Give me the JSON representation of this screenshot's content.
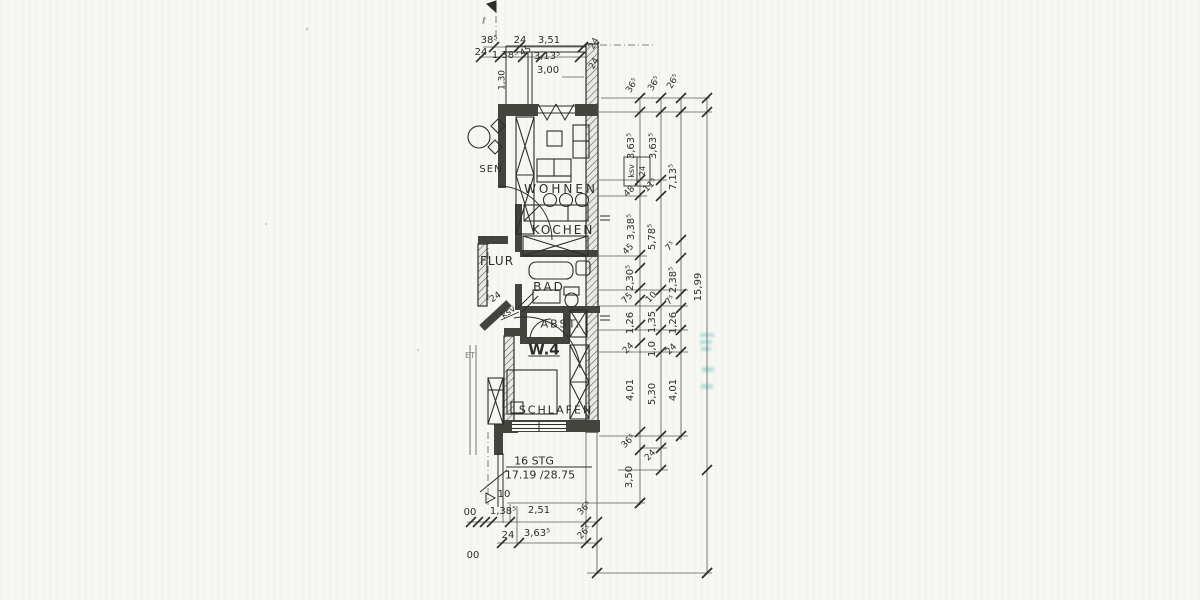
{
  "colors": {
    "paper": "#f7f7f4",
    "ink": "#2c2c2a",
    "wall": "#44443f",
    "stamp_teal": "#86cfc5"
  },
  "plan": {
    "apartment": "W.4",
    "room_names": [
      "WOHNEN",
      "KOCHEN",
      "FLUR",
      "BAD",
      "ABST.",
      "SCHLAFEN"
    ],
    "stair_note": {
      "steps": "16 STG",
      "rise_run": "17.19 /28.75"
    },
    "total_length": "15,99",
    "level_value": "10"
  },
  "labels": [
    {
      "name": "room-label-wohnen",
      "text": "WOHNEN",
      "x": 561,
      "y": 189,
      "fs": 12,
      "ls": 3
    },
    {
      "name": "room-label-kochen",
      "text": "KOCHEN",
      "x": 563,
      "y": 230,
      "fs": 12,
      "ls": 2
    },
    {
      "name": "room-label-flur",
      "text": "FLUR",
      "x": 497,
      "y": 261,
      "fs": 12,
      "ls": 1
    },
    {
      "name": "room-label-bad",
      "text": "BAD",
      "x": 549,
      "y": 287,
      "fs": 12,
      "ls": 2
    },
    {
      "name": "room-label-abst",
      "text": "ABST.",
      "x": 561,
      "y": 324,
      "fs": 11,
      "ls": 2
    },
    {
      "name": "room-label-schlafen",
      "text": "SCHLAFEN",
      "x": 556,
      "y": 410,
      "fs": 11,
      "ls": 2
    },
    {
      "name": "room-label-essen-partial",
      "text": "SEN",
      "x": 491,
      "y": 170,
      "fs": 10,
      "ls": 1
    },
    {
      "name": "apartment-label",
      "text": "W.4",
      "x": 544,
      "y": 350,
      "fs": 15,
      "b": 1,
      "u": 1
    },
    {
      "name": "stairs-count",
      "text": "16 STG",
      "x": 534,
      "y": 461,
      "fs": 11
    },
    {
      "name": "stairs-ratio",
      "text": "17.19 /28.75",
      "x": 540,
      "y": 475,
      "fs": 11
    },
    {
      "name": "level-value",
      "text": "10",
      "x": 504,
      "y": 495,
      "fs": 10
    },
    {
      "name": "fragment-et",
      "text": "ET",
      "x": 470,
      "y": 356,
      "fs": 8,
      "op": 0.6
    },
    {
      "name": "mark-topleft",
      "text": "ℓ",
      "x": 484,
      "y": 22,
      "fs": 9,
      "op": 0.7
    },
    {
      "name": "dim-label",
      "text": "38⁵",
      "x": 489,
      "y": 41,
      "fs": 10
    },
    {
      "name": "dim-label",
      "text": "24",
      "x": 520,
      "y": 41,
      "fs": 10
    },
    {
      "name": "dim-label",
      "text": "3,51",
      "x": 549,
      "y": 41,
      "fs": 10
    },
    {
      "name": "dim-label",
      "text": "24",
      "x": 481,
      "y": 53,
      "fs": 10
    },
    {
      "name": "dim-label",
      "text": "1,38⁵",
      "x": 505,
      "y": 56,
      "fs": 10
    },
    {
      "name": "dim-label",
      "text": "45",
      "x": 526,
      "y": 52,
      "fs": 9,
      "rot": -30
    },
    {
      "name": "dim-label",
      "text": "3,13⁵",
      "x": 547,
      "y": 57,
      "fs": 10
    },
    {
      "name": "dim-label",
      "text": "3,00",
      "x": 548,
      "y": 71,
      "fs": 10
    },
    {
      "name": "dim-label",
      "text": "1,30",
      "x": 503,
      "y": 80,
      "fs": 9,
      "rot": -90
    },
    {
      "name": "dim-label",
      "text": "24",
      "x": 595,
      "y": 44,
      "fs": 9,
      "rot": -60
    },
    {
      "name": "dim-label",
      "text": "24",
      "x": 595,
      "y": 64,
      "fs": 9,
      "rot": -60
    },
    {
      "name": "dim-label",
      "text": "36⁵",
      "x": 633,
      "y": 86,
      "fs": 9,
      "rot": -60
    },
    {
      "name": "dim-label",
      "text": "36⁵",
      "x": 655,
      "y": 84,
      "fs": 9,
      "rot": -60
    },
    {
      "name": "dim-label",
      "text": "26⁵",
      "x": 674,
      "y": 82,
      "fs": 9,
      "rot": -60
    },
    {
      "name": "dim-label",
      "text": "3,63⁵",
      "x": 632,
      "y": 146,
      "fs": 10,
      "rot": -90
    },
    {
      "name": "dim-label-ksv",
      "text": "ksv",
      "x": 632,
      "y": 171,
      "fs": 8,
      "rot": -90
    },
    {
      "name": "dim-label",
      "text": "24",
      "x": 643,
      "y": 171,
      "fs": 8,
      "rot": -90
    },
    {
      "name": "dim-label",
      "text": "48",
      "x": 630,
      "y": 192,
      "fs": 9,
      "rot": -45
    },
    {
      "name": "dim-label",
      "text": "3,38⁵",
      "x": 632,
      "y": 227,
      "fs": 10,
      "rot": -90
    },
    {
      "name": "dim-label",
      "text": "45",
      "x": 629,
      "y": 250,
      "fs": 9,
      "rot": -45
    },
    {
      "name": "dim-label",
      "text": "2,30⁵",
      "x": 631,
      "y": 278,
      "fs": 10,
      "rot": -90
    },
    {
      "name": "dim-label",
      "text": "75",
      "x": 628,
      "y": 299,
      "fs": 9,
      "rot": -45
    },
    {
      "name": "dim-label",
      "text": "1,26",
      "x": 631,
      "y": 323,
      "fs": 10,
      "rot": -90
    },
    {
      "name": "dim-label",
      "text": "24",
      "x": 629,
      "y": 349,
      "fs": 9,
      "rot": -45
    },
    {
      "name": "dim-label",
      "text": "4,01",
      "x": 631,
      "y": 390,
      "fs": 10,
      "rot": -90
    },
    {
      "name": "dim-label",
      "text": "36⁵",
      "x": 629,
      "y": 442,
      "fs": 9,
      "rot": -45
    },
    {
      "name": "dim-label",
      "text": "3,50",
      "x": 630,
      "y": 477,
      "fs": 10,
      "rot": -90
    },
    {
      "name": "dim-label",
      "text": "3,63⁵",
      "x": 654,
      "y": 146,
      "fs": 10,
      "rot": -90
    },
    {
      "name": "dim-label",
      "text": "11⁵",
      "x": 651,
      "y": 186,
      "fs": 9,
      "rot": -45
    },
    {
      "name": "dim-label",
      "text": "5,78⁵",
      "x": 653,
      "y": 237,
      "fs": 10,
      "rot": -90
    },
    {
      "name": "dim-label",
      "text": "10",
      "x": 652,
      "y": 298,
      "fs": 9,
      "rot": -45
    },
    {
      "name": "dim-label",
      "text": "1,35",
      "x": 653,
      "y": 322,
      "fs": 10,
      "rot": -90
    },
    {
      "name": "dim-label",
      "text": "1,0",
      "x": 653,
      "y": 349,
      "fs": 10,
      "rot": -90
    },
    {
      "name": "dim-label",
      "text": "5,30",
      "x": 653,
      "y": 394,
      "fs": 10,
      "rot": -90
    },
    {
      "name": "dim-label",
      "text": "24",
      "x": 651,
      "y": 456,
      "fs": 9,
      "rot": -45
    },
    {
      "name": "dim-label",
      "text": "7,13⁵",
      "x": 674,
      "y": 177,
      "fs": 10,
      "rot": -90
    },
    {
      "name": "dim-label",
      "text": "7⁵",
      "x": 671,
      "y": 247,
      "fs": 9,
      "rot": -45
    },
    {
      "name": "dim-label",
      "text": "2,38⁵",
      "x": 674,
      "y": 280,
      "fs": 10,
      "rot": -90
    },
    {
      "name": "dim-label",
      "text": "7⁵",
      "x": 671,
      "y": 301,
      "fs": 9,
      "rot": -45
    },
    {
      "name": "dim-label",
      "text": "1,26",
      "x": 674,
      "y": 323,
      "fs": 10,
      "rot": -90
    },
    {
      "name": "dim-label",
      "text": "24",
      "x": 672,
      "y": 350,
      "fs": 9,
      "rot": -45
    },
    {
      "name": "dim-label",
      "text": "4,01",
      "x": 674,
      "y": 390,
      "fs": 10,
      "rot": -90
    },
    {
      "name": "dim-total-length",
      "text": "15,99",
      "x": 699,
      "y": 287,
      "fs": 10,
      "rot": -90
    },
    {
      "name": "dim-label",
      "text": "00",
      "x": 470,
      "y": 513,
      "fs": 10
    },
    {
      "name": "dim-label",
      "text": "1,38⁵",
      "x": 503,
      "y": 512,
      "fs": 10
    },
    {
      "name": "dim-label",
      "text": "2,51",
      "x": 539,
      "y": 511,
      "fs": 10
    },
    {
      "name": "dim-label",
      "text": "36⁵",
      "x": 585,
      "y": 509,
      "fs": 9,
      "rot": -45
    },
    {
      "name": "dim-label",
      "text": "24",
      "x": 508,
      "y": 536,
      "fs": 10
    },
    {
      "name": "dim-label",
      "text": "3,63⁵",
      "x": 537,
      "y": 534,
      "fs": 10
    },
    {
      "name": "dim-label",
      "text": "26⁵",
      "x": 585,
      "y": 533,
      "fs": 9,
      "rot": -45
    },
    {
      "name": "dim-label",
      "text": "00",
      "x": 473,
      "y": 556,
      "fs": 10
    },
    {
      "name": "wall-note",
      "text": "24",
      "x": 496,
      "y": 298,
      "fs": 9,
      "rot": -35
    },
    {
      "name": "wall-note-ksv",
      "text": "ksv",
      "x": 509,
      "y": 313,
      "fs": 9,
      "rot": -35
    }
  ]
}
